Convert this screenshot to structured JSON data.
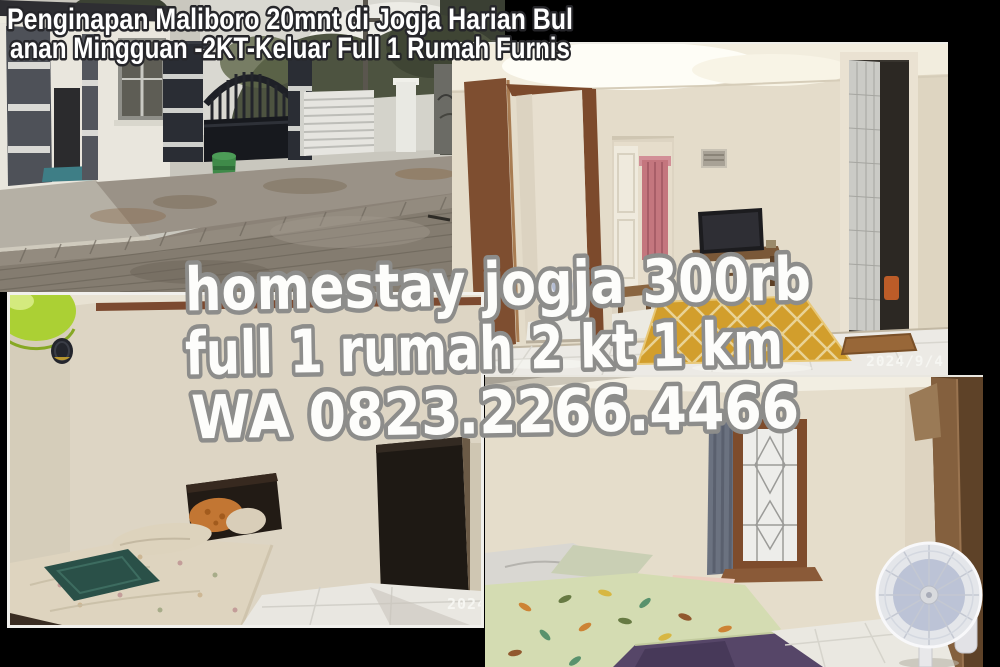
{
  "canvas": {
    "width": 1000,
    "height": 667,
    "background": "#000000"
  },
  "listing_title": {
    "line1": "Penginapan Maliboro 20mnt di Jogja Harian Bul",
    "line2": "anan Mingguan -2KT-Keluar Full 1 Rumah Furnis",
    "text_color": "#ffffff",
    "outline_color": "#26262a"
  },
  "promo_overlay": {
    "line1": "homestay jogja 300rb",
    "line2": "full 1 rumah 2 kt 1 km",
    "line3": "WA 0823.2266.4466",
    "text_color": "#fdfdfb",
    "outline_color": "#8d8d8b"
  },
  "photos": {
    "exterior_street": {
      "alt": "house exterior with dark gate, white fence, green bin and paved street"
    },
    "living_room": {
      "timestamp": "2024/9/4",
      "alt": "living room with open door, TV, yellow rug and bathroom doorway"
    },
    "bedroom_one": {
      "timestamp": "2024.",
      "alt": "bedroom with green lamp, single bed and dark wardrobe"
    },
    "bedroom_two": {
      "alt": "bedroom with window, curtain, floral bed and standing fan"
    }
  }
}
